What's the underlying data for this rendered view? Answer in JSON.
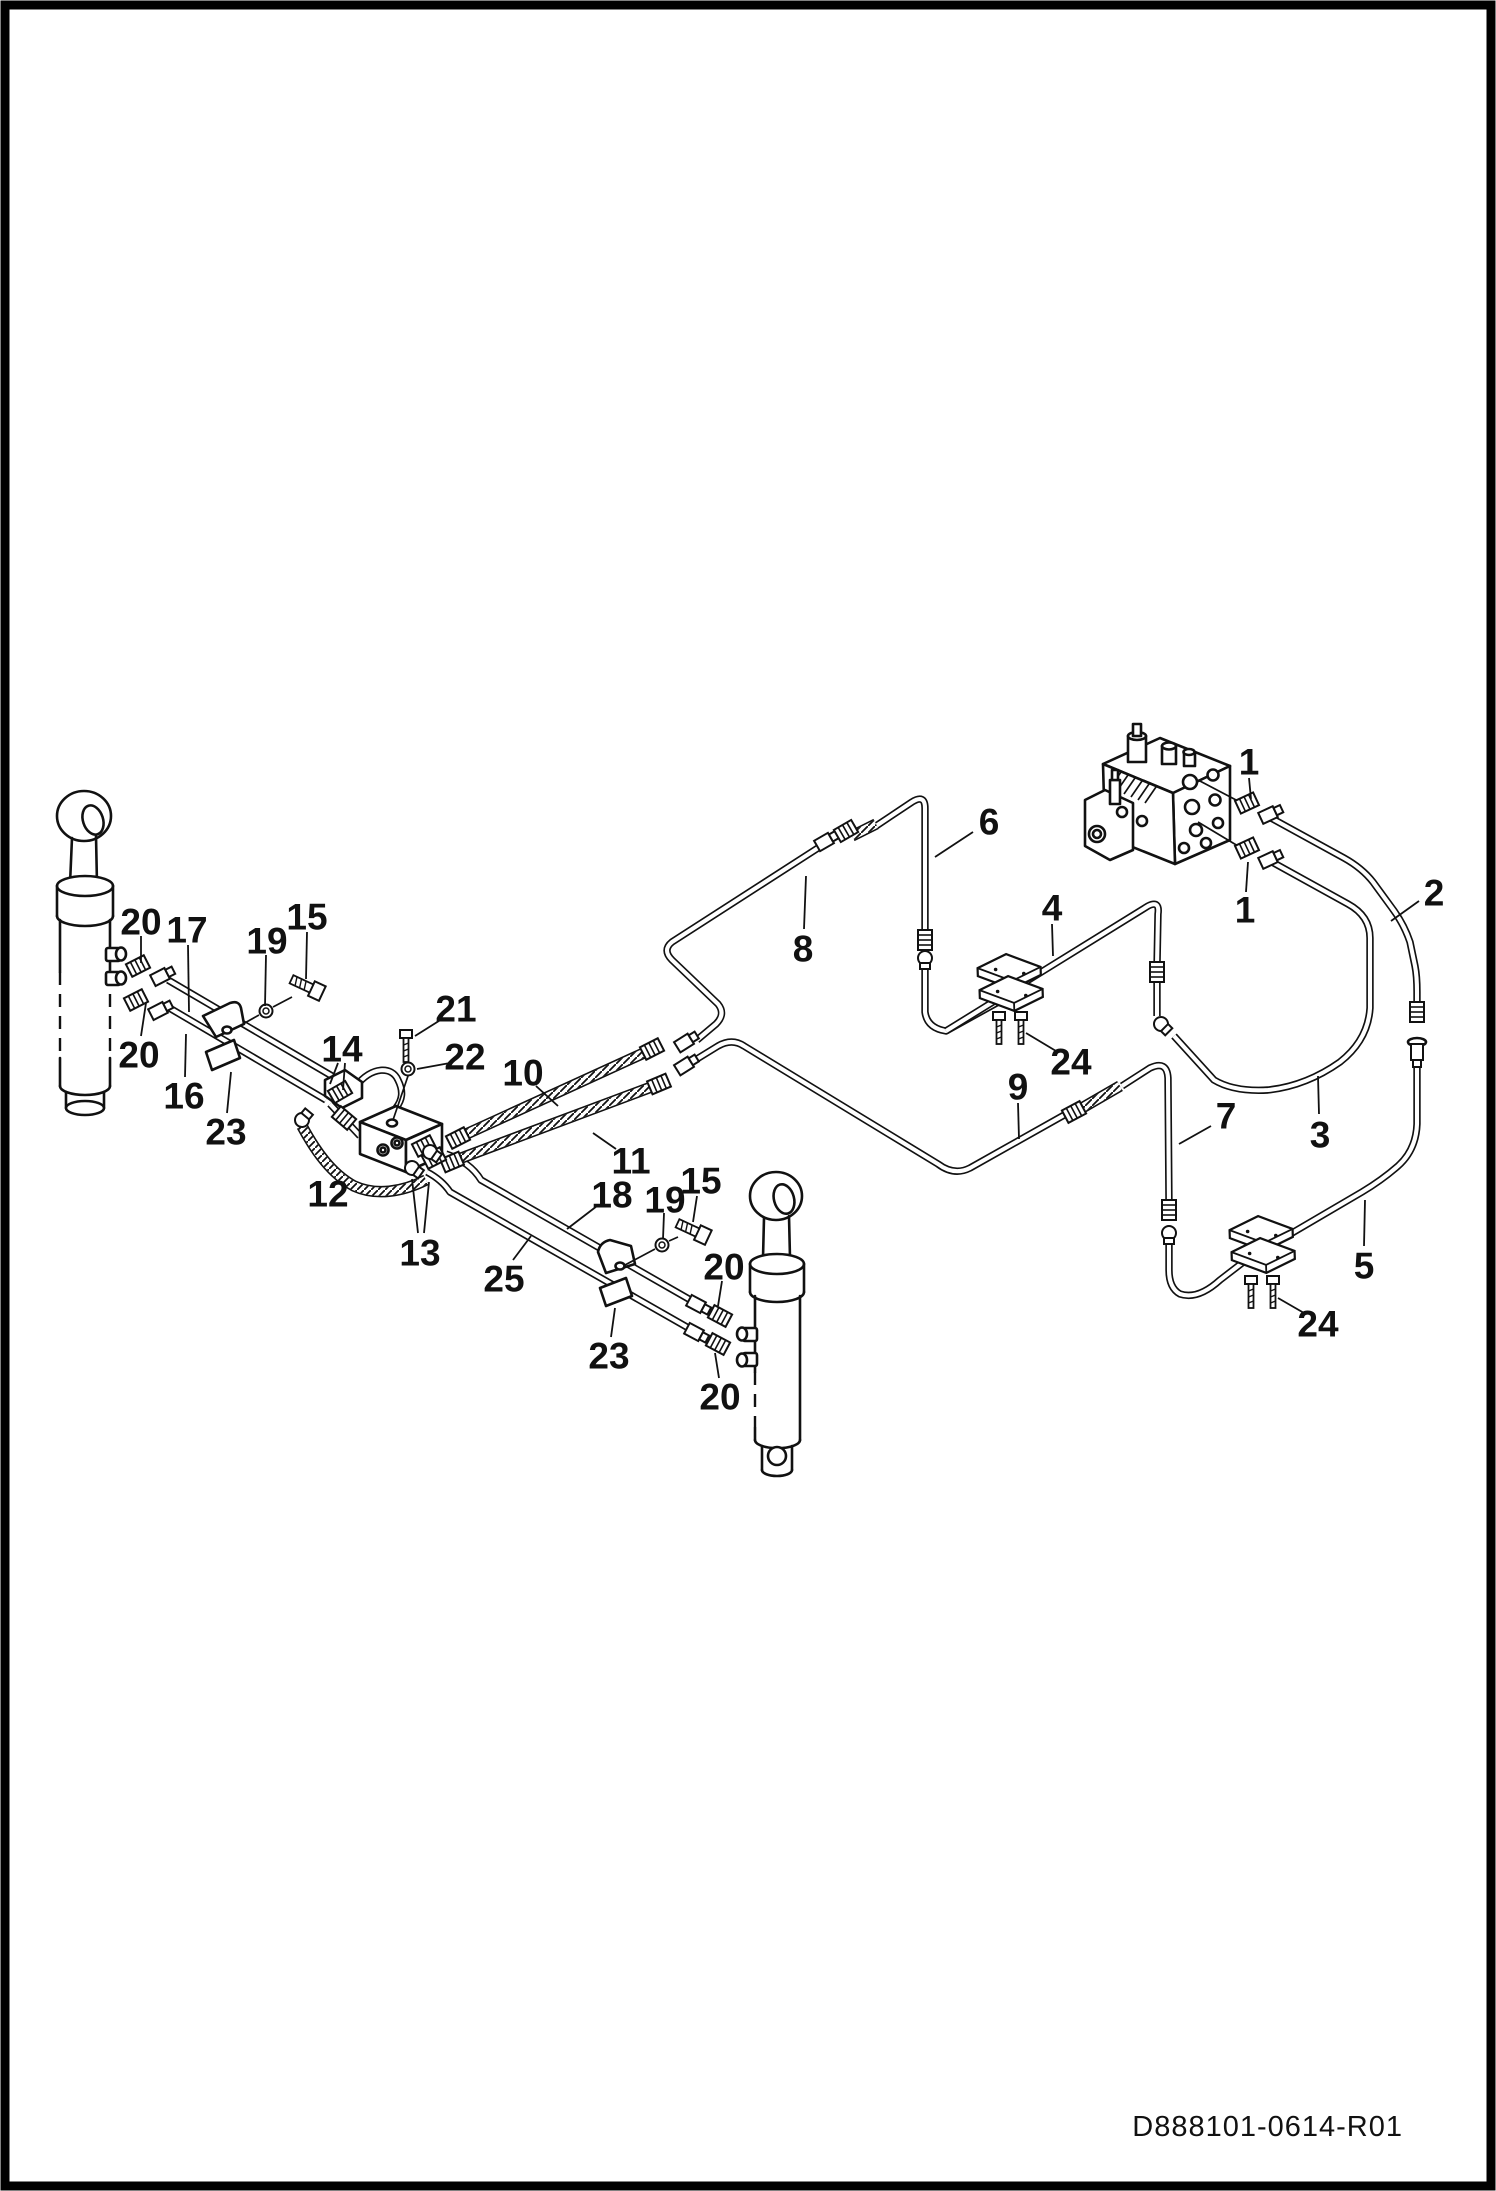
{
  "footer": {
    "drawing_code": "D888101-0614-R01"
  },
  "diagram": {
    "type": "exploded-parts-diagram",
    "subject": "hydraulic-cylinder-hose-routing",
    "ink_color": "#111111",
    "paper_color": "#ffffff",
    "callouts": [
      {
        "text": "1",
        "x": 1249,
        "y": 762,
        "leaders": [
          [
            1249,
            778,
            1251,
            799
          ]
        ]
      },
      {
        "text": "1",
        "x": 1245,
        "y": 910,
        "leaders": [
          [
            1246,
            892,
            1248,
            862
          ]
        ]
      },
      {
        "text": "2",
        "x": 1434,
        "y": 893,
        "leaders": [
          [
            1419,
            901,
            1391,
            921
          ]
        ]
      },
      {
        "text": "3",
        "x": 1320,
        "y": 1135,
        "leaders": [
          [
            1319,
            1114,
            1318,
            1076
          ]
        ]
      },
      {
        "text": "4",
        "x": 1052,
        "y": 908,
        "leaders": [
          [
            1052,
            924,
            1053,
            956
          ]
        ]
      },
      {
        "text": "5",
        "x": 1364,
        "y": 1266,
        "leaders": [
          [
            1364,
            1246,
            1365,
            1200
          ]
        ]
      },
      {
        "text": "6",
        "x": 989,
        "y": 822,
        "leaders": [
          [
            973,
            832,
            935,
            857
          ]
        ]
      },
      {
        "text": "7",
        "x": 1226,
        "y": 1116,
        "leaders": [
          [
            1211,
            1126,
            1179,
            1144
          ]
        ]
      },
      {
        "text": "8",
        "x": 803,
        "y": 949,
        "leaders": [
          [
            804,
            929,
            806,
            876
          ]
        ]
      },
      {
        "text": "9",
        "x": 1018,
        "y": 1087,
        "leaders": [
          [
            1018,
            1103,
            1019,
            1139
          ]
        ]
      },
      {
        "text": "10",
        "x": 523,
        "y": 1073,
        "leaders": [
          [
            536,
            1086,
            558,
            1106
          ]
        ]
      },
      {
        "text": "11",
        "x": 631,
        "y": 1161,
        "leaders": [
          [
            616,
            1149,
            593,
            1133
          ]
        ]
      },
      {
        "text": "12",
        "x": 328,
        "y": 1194,
        "leaders": []
      },
      {
        "text": "13",
        "x": 420,
        "y": 1253,
        "leaders": [
          [
            418,
            1233,
            412,
            1179
          ],
          [
            424,
            1233,
            429,
            1182
          ]
        ]
      },
      {
        "text": "14",
        "x": 342,
        "y": 1049,
        "leaders": [
          [
            338,
            1063,
            330,
            1084
          ],
          [
            345,
            1063,
            343,
            1090
          ]
        ]
      },
      {
        "text": "15",
        "x": 307,
        "y": 917,
        "leaders": [
          [
            307,
            932,
            306,
            979
          ]
        ]
      },
      {
        "text": "15",
        "x": 701,
        "y": 1181,
        "leaders": [
          [
            697,
            1196,
            693,
            1222
          ]
        ]
      },
      {
        "text": "16",
        "x": 184,
        "y": 1096,
        "leaders": [
          [
            185,
            1077,
            186,
            1034
          ]
        ]
      },
      {
        "text": "17",
        "x": 187,
        "y": 930,
        "leaders": [
          [
            188,
            945,
            189,
            1012
          ]
        ]
      },
      {
        "text": "18",
        "x": 612,
        "y": 1195,
        "leaders": [
          [
            597,
            1206,
            567,
            1229
          ]
        ]
      },
      {
        "text": "19",
        "x": 267,
        "y": 941,
        "leaders": [
          [
            266,
            955,
            265,
            1006
          ]
        ]
      },
      {
        "text": "19",
        "x": 665,
        "y": 1200,
        "leaders": [
          [
            664,
            1213,
            663,
            1239
          ]
        ]
      },
      {
        "text": "20",
        "x": 141,
        "y": 922,
        "leaders": [
          [
            141,
            936,
            141,
            963
          ]
        ]
      },
      {
        "text": "20",
        "x": 139,
        "y": 1055,
        "leaders": [
          [
            141,
            1036,
            146,
            1003
          ]
        ]
      },
      {
        "text": "20",
        "x": 724,
        "y": 1267,
        "leaders": [
          [
            722,
            1281,
            718,
            1306
          ]
        ]
      },
      {
        "text": "20",
        "x": 720,
        "y": 1397,
        "leaders": [
          [
            719,
            1378,
            715,
            1353
          ]
        ]
      },
      {
        "text": "21",
        "x": 456,
        "y": 1009,
        "leaders": [
          [
            442,
            1019,
            415,
            1036
          ]
        ]
      },
      {
        "text": "22",
        "x": 465,
        "y": 1057,
        "leaders": [
          [
            450,
            1063,
            417,
            1069
          ]
        ]
      },
      {
        "text": "23",
        "x": 226,
        "y": 1132,
        "leaders": [
          [
            227,
            1113,
            231,
            1072
          ]
        ]
      },
      {
        "text": "23",
        "x": 609,
        "y": 1356,
        "leaders": [
          [
            611,
            1337,
            615,
            1308
          ]
        ]
      },
      {
        "text": "24",
        "x": 1071,
        "y": 1062,
        "leaders": [
          [
            1056,
            1051,
            1026,
            1033
          ]
        ]
      },
      {
        "text": "24",
        "x": 1318,
        "y": 1324,
        "leaders": [
          [
            1304,
            1313,
            1278,
            1298
          ]
        ]
      },
      {
        "text": "25",
        "x": 504,
        "y": 1279,
        "leaders": [
          [
            513,
            1260,
            531,
            1236
          ]
        ]
      }
    ]
  }
}
